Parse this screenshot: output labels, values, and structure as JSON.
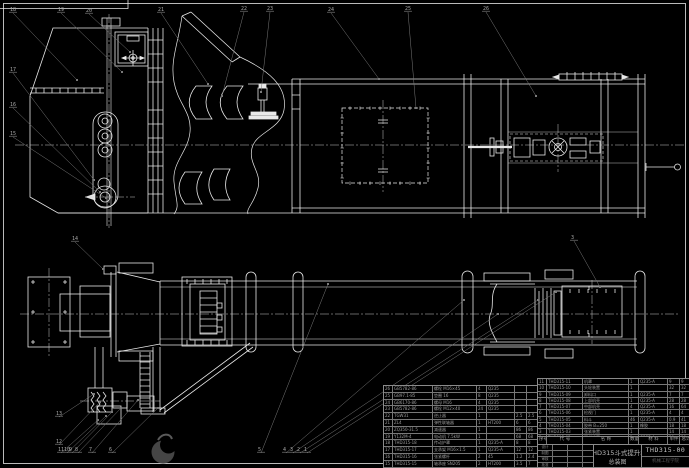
{
  "colors": {
    "background": "#000000",
    "line": "#e8e8e8",
    "leader": "#7a7a7a",
    "table_text": "#9c9c9c",
    "title_text": "#b8b8b8",
    "org_text": "#565656"
  },
  "title_block": {
    "product": "THD315斗式提升机",
    "sheet": "总装图",
    "drawing_no": "THD315-00",
    "org": "机械工程学院",
    "sig_labels": [
      "设计",
      "制图",
      "审核",
      "批准"
    ]
  },
  "bom_header": {
    "rows": [
      [
        "序号",
        "代  号",
        "名  称",
        "数量",
        "材  料",
        "单件",
        "总计",
        "备注"
      ]
    ]
  },
  "bom_right": {
    "rows": [
      [
        "11",
        "THD315-11",
        "机罩",
        "1",
        "Q235-A",
        "9",
        "9",
        ""
      ],
      [
        "10",
        "THD315-10",
        "头轮装置",
        "1",
        "",
        "32",
        "32",
        ""
      ],
      [
        "9",
        "THD315-09",
        "卸料口",
        "1",
        "Q235-A",
        "7",
        "7",
        ""
      ],
      [
        "8",
        "THD315-08",
        "上部机壳",
        "1",
        "Q235-A",
        "28",
        "28",
        ""
      ],
      [
        "7",
        "THD315-07",
        "中部机壳",
        "4",
        "Q235-A",
        "16",
        "64",
        ""
      ],
      [
        "6",
        "THD315-06",
        "检视门",
        "1",
        "Q235-A",
        "4",
        "4",
        ""
      ],
      [
        "5",
        "THD315-05",
        "料斗",
        "46",
        "Q235-A",
        "0.9",
        "41",
        ""
      ],
      [
        "4",
        "THD315-04",
        "胶带 B=250",
        "1",
        "橡胶",
        "18",
        "18",
        "硫化接头"
      ],
      [
        "3",
        "THD315-03",
        "张紧装置",
        "1",
        "",
        "14",
        "14",
        ""
      ],
      [
        "2",
        "THD315-02",
        "下部机壳",
        "1",
        "Q235-A",
        "30",
        "30",
        ""
      ],
      [
        "1",
        "THD315-01",
        "进料口",
        "1",
        "Q235-A",
        "8",
        "8",
        ""
      ]
    ]
  },
  "bom_left": {
    "rows": [
      [
        "26",
        "GB5782-86",
        "螺栓 M16×45",
        "4",
        "Q235",
        "",
        "",
        ""
      ],
      [
        "25",
        "GB97.1-85",
        "垫圈 16",
        "8",
        "Q235",
        "",
        "",
        ""
      ],
      [
        "24",
        "GB6170-86",
        "螺母 M16",
        "4",
        "Q235",
        "",
        "",
        ""
      ],
      [
        "23",
        "GB5782-86",
        "螺栓 M12×40",
        "24",
        "Q235",
        "",
        "",
        ""
      ],
      [
        "22",
        "TGW31",
        "逆止器",
        "1",
        "",
        "2.5",
        "2.5",
        ""
      ],
      [
        "21",
        "ZL4",
        "弹性联轴器",
        "1",
        "HT200",
        "6",
        "6",
        ""
      ],
      [
        "20",
        "ZQ350-31.5",
        "减速器",
        "1",
        "",
        "86",
        "86",
        "外购"
      ],
      [
        "19",
        "Y132M-4",
        "电动机 7.5kW",
        "1",
        "",
        "68",
        "68",
        "外购"
      ],
      [
        "18",
        "THD315-18",
        "传动护罩",
        "1",
        "Q235-A",
        "8",
        "8",
        ""
      ],
      [
        "17",
        "THD315-17",
        "支承架 M16×1.5",
        "1",
        "Q235-A",
        "12",
        "12",
        ""
      ],
      [
        "16",
        "THD315-16",
        "张紧螺杆",
        "2",
        "45",
        "1.2",
        "2.4",
        ""
      ],
      [
        "15",
        "THD315-15",
        "轴承座 SN205",
        "2",
        "HT200",
        "3.5",
        "7",
        ""
      ],
      [
        "14",
        "THD315-14",
        "底轮装置",
        "1",
        "Q235-A",
        "24",
        "24",
        ""
      ],
      [
        "13",
        "THD315-13",
        "给料口",
        "1",
        "Q235-A",
        "10",
        "10",
        ""
      ]
    ]
  },
  "callouts": [
    {
      "label": "18",
      "x": 10,
      "y": 6,
      "tx": 77,
      "ty": 80
    },
    {
      "label": "19",
      "x": 58,
      "y": 6,
      "tx": 122,
      "ty": 72
    },
    {
      "label": "20",
      "x": 86,
      "y": 7,
      "tx": 130,
      "ty": 52
    },
    {
      "label": "21",
      "x": 158,
      "y": 6,
      "tx": 208,
      "ty": 84
    },
    {
      "label": "22",
      "x": 241,
      "y": 5,
      "tx": 222,
      "ty": 96
    },
    {
      "label": "23",
      "x": 267,
      "y": 5,
      "tx": 261,
      "ty": 92
    },
    {
      "label": "24",
      "x": 328,
      "y": 6,
      "tx": 379,
      "ty": 79
    },
    {
      "label": "25",
      "x": 405,
      "y": 5,
      "tx": 416,
      "ty": 108
    },
    {
      "label": "26",
      "x": 483,
      "y": 5,
      "tx": 536,
      "ty": 96
    },
    {
      "label": "17",
      "x": 10,
      "y": 66,
      "tx": 94,
      "ty": 180
    },
    {
      "label": "16",
      "x": 10,
      "y": 101,
      "tx": 100,
      "ty": 192
    },
    {
      "label": "15",
      "x": 10,
      "y": 130,
      "tx": 106,
      "ty": 198
    },
    {
      "label": "14",
      "x": 72,
      "y": 235,
      "tx": 103,
      "ty": 269
    },
    {
      "label": "3",
      "x": 571,
      "y": 234,
      "tx": 600,
      "ty": 287
    },
    {
      "label": "13",
      "x": 56,
      "y": 410,
      "tx": 94,
      "ty": 394
    },
    {
      "label": "12",
      "x": 56,
      "y": 438,
      "tx": 100,
      "ty": 402
    },
    {
      "label": "11",
      "x": 58,
      "y": 446,
      "tx": 98,
      "ty": 420
    },
    {
      "label": "10",
      "x": 64,
      "y": 446,
      "tx": 106,
      "ty": 416
    },
    {
      "label": "9",
      "x": 69,
      "y": 446,
      "tx": 112,
      "ty": 412
    },
    {
      "label": "8",
      "x": 75,
      "y": 446,
      "tx": 121,
      "ty": 408
    },
    {
      "label": "7",
      "x": 89,
      "y": 446,
      "tx": 138,
      "ty": 400
    },
    {
      "label": "6",
      "x": 109,
      "y": 446,
      "tx": 158,
      "ty": 408
    },
    {
      "label": "5",
      "x": 258,
      "y": 446,
      "tx": 328,
      "ty": 284
    },
    {
      "label": "4",
      "x": 283,
      "y": 446,
      "tx": 464,
      "ty": 300
    },
    {
      "label": "3",
      "x": 290,
      "y": 446,
      "tx": 498,
      "ty": 314
    },
    {
      "label": "2",
      "x": 297,
      "y": 446,
      "tx": 538,
      "ty": 300
    },
    {
      "label": "1",
      "x": 304,
      "y": 446,
      "tx": 556,
      "ty": 292
    }
  ]
}
